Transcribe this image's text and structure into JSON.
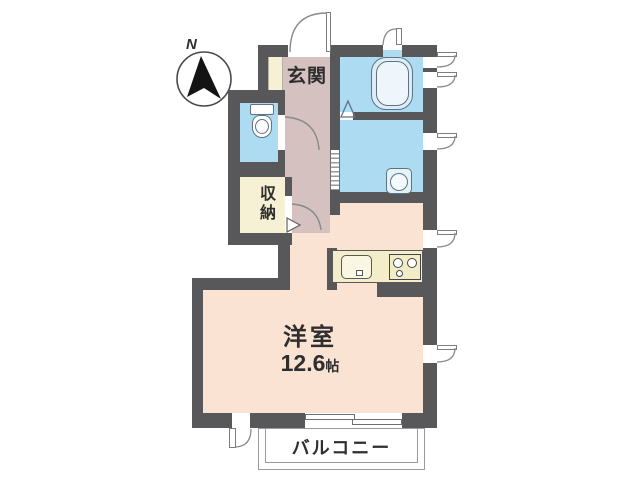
{
  "compass": {
    "north_label": "N",
    "icon": "north-arrow-icon"
  },
  "rooms": {
    "entrance": {
      "label": "玄関"
    },
    "storage": {
      "label": "収納"
    },
    "main_room": {
      "label": "洋室",
      "size_value": "12.6",
      "size_unit": "帖"
    },
    "balcony": {
      "label": "バルコニー"
    }
  },
  "fixtures": {
    "bathtub": "bathtub-icon",
    "toilet": "toilet-icon",
    "washbasin": "washbasin-icon",
    "kitchen_sink": "kitchen-sink-icon",
    "stove": "stove-burners-icon"
  },
  "colors": {
    "wall": "#58585a",
    "hall_floor": "#d5c2c0",
    "main_room_floor": "#fbe3d3",
    "wet_area_floor": "#addcf2",
    "storage_floor": "#f6f0d5",
    "kitchen_counter": "#f3edca"
  }
}
